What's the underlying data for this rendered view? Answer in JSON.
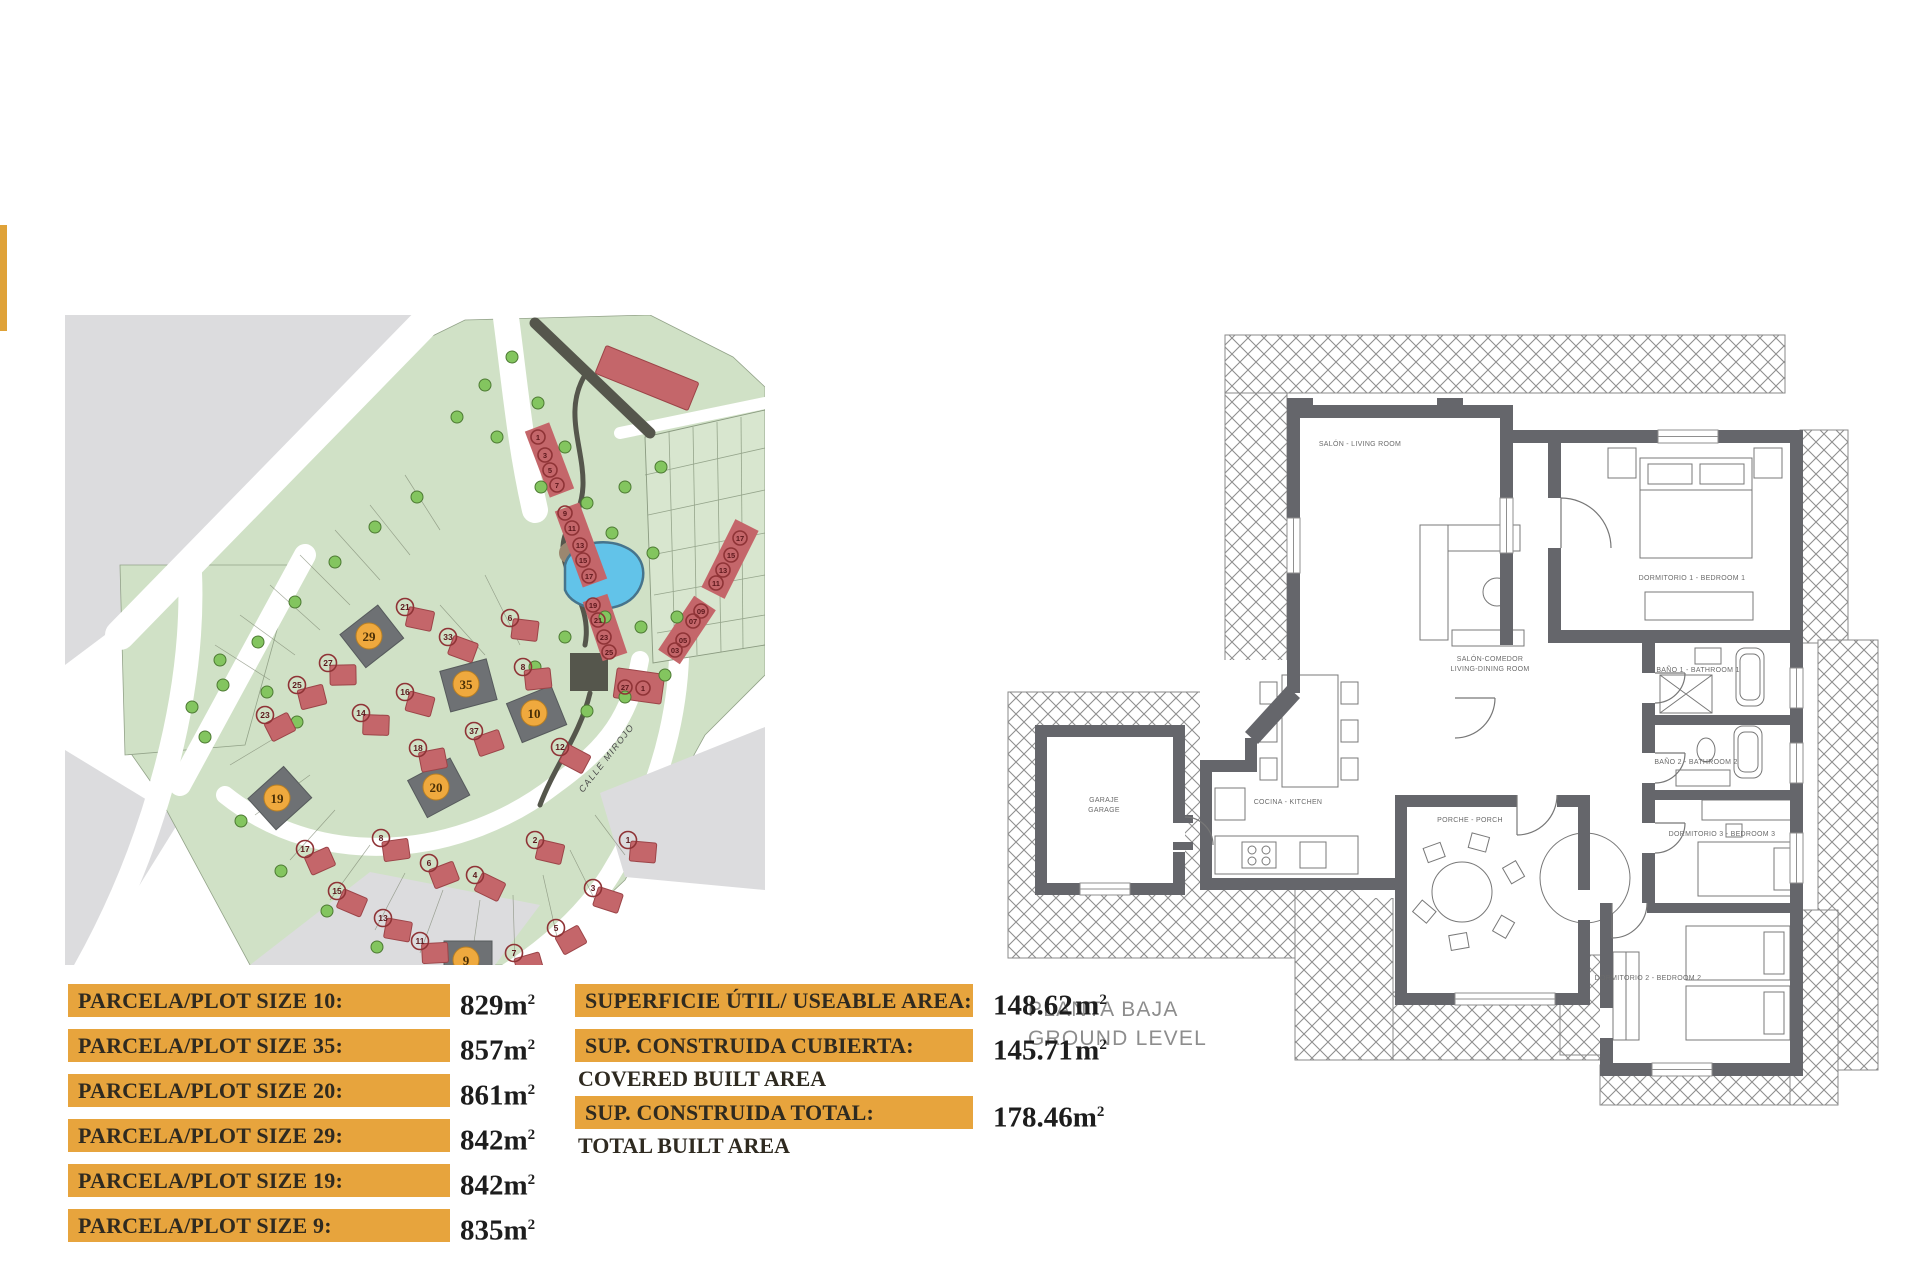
{
  "accent": {
    "gold": "#DFA238",
    "orange_bar": "#E7A43D",
    "plot_red": "#C4666A",
    "plot_dark": "#6E7174",
    "pond_blue": "#62C3E9"
  },
  "site_plan": {
    "street_label": "CALLE MIROJO",
    "highlighted_plots": [
      "29",
      "35",
      "10",
      "20",
      "19",
      "9"
    ],
    "markers": [
      {
        "n": "29",
        "x": 304,
        "y": 321,
        "t": "o",
        "rot": -38
      },
      {
        "n": "35",
        "x": 401,
        "y": 369,
        "t": "o",
        "rot": -15
      },
      {
        "n": "10",
        "x": 469,
        "y": 398,
        "t": "o",
        "rot": -22
      },
      {
        "n": "20",
        "x": 371,
        "y": 472,
        "t": "o",
        "rot": -28
      },
      {
        "n": "19",
        "x": 212,
        "y": 483,
        "t": "o",
        "rot": -42
      },
      {
        "n": "9",
        "x": 401,
        "y": 645,
        "t": "o",
        "rot": 0
      },
      {
        "n": "21",
        "x": 340,
        "y": 292,
        "t": "r"
      },
      {
        "n": "27",
        "x": 263,
        "y": 348,
        "t": "r"
      },
      {
        "n": "25",
        "x": 232,
        "y": 370,
        "t": "r"
      },
      {
        "n": "23",
        "x": 200,
        "y": 400,
        "t": "r"
      },
      {
        "n": "33",
        "x": 383,
        "y": 322,
        "t": "r"
      },
      {
        "n": "6",
        "x": 445,
        "y": 303,
        "t": "r"
      },
      {
        "n": "8",
        "x": 458,
        "y": 352,
        "t": "r"
      },
      {
        "n": "37",
        "x": 409,
        "y": 416,
        "t": "r"
      },
      {
        "n": "12",
        "x": 495,
        "y": 432,
        "t": "r"
      },
      {
        "n": "16",
        "x": 340,
        "y": 377,
        "t": "r"
      },
      {
        "n": "14",
        "x": 296,
        "y": 398,
        "t": "r"
      },
      {
        "n": "18",
        "x": 353,
        "y": 433,
        "t": "r"
      },
      {
        "n": "17",
        "x": 240,
        "y": 534,
        "t": "r"
      },
      {
        "n": "15",
        "x": 272,
        "y": 576,
        "t": "r"
      },
      {
        "n": "13",
        "x": 318,
        "y": 603,
        "t": "r"
      },
      {
        "n": "11",
        "x": 355,
        "y": 626,
        "t": "r"
      },
      {
        "n": "7",
        "x": 449,
        "y": 638,
        "t": "r"
      },
      {
        "n": "5",
        "x": 491,
        "y": 613,
        "t": "r"
      },
      {
        "n": "3",
        "x": 528,
        "y": 573,
        "t": "r"
      },
      {
        "n": "1",
        "x": 563,
        "y": 525,
        "t": "r"
      },
      {
        "n": "8",
        "x": 316,
        "y": 523,
        "t": "r"
      },
      {
        "n": "6",
        "x": 364,
        "y": 548,
        "t": "r"
      },
      {
        "n": "4",
        "x": 410,
        "y": 560,
        "t": "r"
      },
      {
        "n": "2",
        "x": 470,
        "y": 525,
        "t": "r"
      },
      {
        "n": "1",
        "x": 473,
        "y": 122,
        "t": "r",
        "s": 1
      },
      {
        "n": "3",
        "x": 480,
        "y": 140,
        "t": "r",
        "s": 1
      },
      {
        "n": "5",
        "x": 485,
        "y": 155,
        "t": "r",
        "s": 1
      },
      {
        "n": "7",
        "x": 492,
        "y": 170,
        "t": "r",
        "s": 1
      },
      {
        "n": "9",
        "x": 500,
        "y": 198,
        "t": "r",
        "s": 1
      },
      {
        "n": "11",
        "x": 507,
        "y": 213,
        "t": "r",
        "s": 1
      },
      {
        "n": "13",
        "x": 515,
        "y": 230,
        "t": "r",
        "s": 1
      },
      {
        "n": "15",
        "x": 518,
        "y": 245,
        "t": "r",
        "s": 1
      },
      {
        "n": "17",
        "x": 524,
        "y": 261,
        "t": "r",
        "s": 1
      },
      {
        "n": "19",
        "x": 528,
        "y": 290,
        "t": "r",
        "s": 1
      },
      {
        "n": "21",
        "x": 533,
        "y": 305,
        "t": "r",
        "s": 1
      },
      {
        "n": "23",
        "x": 539,
        "y": 322,
        "t": "r",
        "s": 1
      },
      {
        "n": "25",
        "x": 544,
        "y": 337,
        "t": "r",
        "s": 1
      },
      {
        "n": "27",
        "x": 560,
        "y": 372,
        "t": "r",
        "s": 1
      },
      {
        "n": "1",
        "x": 578,
        "y": 373,
        "t": "r",
        "s": 1
      },
      {
        "n": "17",
        "x": 675,
        "y": 223,
        "t": "r",
        "s": 1
      },
      {
        "n": "15",
        "x": 666,
        "y": 240,
        "t": "r",
        "s": 1
      },
      {
        "n": "13",
        "x": 658,
        "y": 255,
        "t": "r",
        "s": 1
      },
      {
        "n": "11",
        "x": 651,
        "y": 268,
        "t": "r",
        "s": 1
      },
      {
        "n": "09",
        "x": 636,
        "y": 296,
        "t": "r",
        "s": 1
      },
      {
        "n": "07",
        "x": 628,
        "y": 306,
        "t": "r",
        "s": 1
      },
      {
        "n": "05",
        "x": 618,
        "y": 325,
        "t": "r",
        "s": 1
      },
      {
        "n": "03",
        "x": 610,
        "y": 335,
        "t": "r",
        "s": 1
      }
    ],
    "trees": [
      [
        447,
        42
      ],
      [
        473,
        88
      ],
      [
        432,
        122
      ],
      [
        500,
        132
      ],
      [
        476,
        172
      ],
      [
        522,
        188
      ],
      [
        560,
        172
      ],
      [
        596,
        152
      ],
      [
        547,
        218
      ],
      [
        588,
        238
      ],
      [
        612,
        302
      ],
      [
        576,
        312
      ],
      [
        540,
        302
      ],
      [
        500,
        322
      ],
      [
        470,
        352
      ],
      [
        522,
        396
      ],
      [
        560,
        382
      ],
      [
        352,
        182
      ],
      [
        310,
        212
      ],
      [
        270,
        247
      ],
      [
        230,
        287
      ],
      [
        193,
        327
      ],
      [
        158,
        370
      ],
      [
        140,
        422
      ],
      [
        176,
        506
      ],
      [
        216,
        556
      ],
      [
        262,
        596
      ],
      [
        312,
        632
      ],
      [
        155,
        345
      ],
      [
        202,
        377
      ],
      [
        232,
        407
      ],
      [
        127,
        392
      ],
      [
        420,
        70
      ],
      [
        392,
        102
      ],
      [
        600,
        360
      ]
    ]
  },
  "plot_table": {
    "rows": [
      {
        "label": "PARCELA/PLOT SIZE 10:",
        "value": "829",
        "unit": "m",
        "sup": "2"
      },
      {
        "label": "PARCELA/PLOT SIZE 35:",
        "value": "857",
        "unit": "m",
        "sup": "2"
      },
      {
        "label": "PARCELA/PLOT SIZE 20:",
        "value": "861",
        "unit": "m",
        "sup": "2"
      },
      {
        "label": "PARCELA/PLOT SIZE 29:",
        "value": "842",
        "unit": "m",
        "sup": "2"
      },
      {
        "label": "PARCELA/PLOT SIZE 19:",
        "value": "842",
        "unit": "m",
        "sup": "2"
      },
      {
        "label": "PARCELA/PLOT SIZE 9:",
        "value": "835",
        "unit": "m",
        "sup": "2"
      }
    ]
  },
  "area_table": {
    "rows": [
      {
        "label": "SUPERFICIE ÚTIL/ USEABLE AREA:",
        "sublabel": "",
        "value": "148.62",
        "unit": "m",
        "sup": "2"
      },
      {
        "label": "SUP. CONSTRUIDA CUBIERTA:",
        "sublabel": "COVERED BUILT AREA",
        "value": "145.71",
        "unit": "m",
        "sup": "2"
      },
      {
        "label": "SUP. CONSTRUIDA TOTAL:",
        "sublabel": "TOTAL BUILT AREA",
        "value": "178.46",
        "unit": "m",
        "sup": "2"
      }
    ]
  },
  "floor_plan": {
    "title_line1": "PLANTA BAJA",
    "title_line2": "GROUND LEVEL",
    "rooms": {
      "salon": "SALÓN - LIVING ROOM",
      "salon_comedor_1": "SALÓN-COMEDOR",
      "salon_comedor_2": "LIVING-DINING ROOM",
      "cocina": "COCINA - KITCHEN",
      "garaje_1": "GARAJE",
      "garaje_2": "GARAGE",
      "porche": "PORCHE - PORCH",
      "dormitorio1": "DORMITORIO 1 - BEDROOM 1",
      "bano1": "BAÑO 1 - BATHROOM 1",
      "bano2": "BAÑO 2 - BATHROOM 2",
      "dormitorio3": "DORMITORIO 3 - BEDROOM 3",
      "dormitorio2": "DORMITORIO 2 - BEDROOM 2"
    }
  }
}
